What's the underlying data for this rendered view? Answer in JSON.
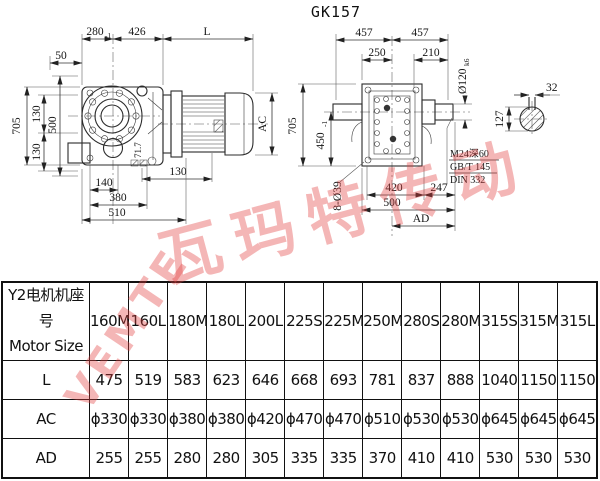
{
  "title": "GK157",
  "watermark": {
    "latin": "VEMTE",
    "cn": "瓦玛特传动"
  },
  "left_view": {
    "dim_280": "280",
    "dim_280_tol": "-1",
    "dim_426": "426",
    "dim_L": "L",
    "dim_50": "50",
    "dim_705": "705",
    "dim_130_top": "130",
    "dim_500": "500",
    "dim_130_mid": "130",
    "dim_130_foot": "130",
    "dim_140": "140",
    "dim_380": "380",
    "dim_510": "510",
    "dim_AC": "AC",
    "dim_angle": "71.7"
  },
  "right_view": {
    "dim_457_left": "457",
    "dim_457_right": "457",
    "dim_250": "250",
    "dim_210": "210",
    "dim_dia120": "Ø120",
    "dim_dia120_tol": "k6",
    "dim_705": "705",
    "dim_450": "450",
    "dim_450_tol": "-1",
    "dim_holes": "8-Ø39",
    "dim_420": "420",
    "dim_247": "247",
    "dim_500": "500",
    "dim_AD": "AD",
    "note_tap": "M24深60",
    "note_gbt": "GB/T 145",
    "note_din": "DIN 332",
    "shaft_key_width": "32",
    "shaft_dia": "127"
  },
  "table": {
    "header_line1": "Y2电机机座号",
    "header_line2": "Motor Size",
    "columns": [
      "160M",
      "160L",
      "180M",
      "180L",
      "200L",
      "225S",
      "225M",
      "250M",
      "280S",
      "280M",
      "315S",
      "315M",
      "315L"
    ],
    "rows": [
      {
        "label": "L",
        "values": [
          "475",
          "519",
          "583",
          "623",
          "646",
          "668",
          "693",
          "781",
          "837",
          "888",
          "1040",
          "1150",
          "1150"
        ]
      },
      {
        "label": "AC",
        "values": [
          "ϕ330",
          "ϕ330",
          "ϕ380",
          "ϕ380",
          "ϕ420",
          "ϕ470",
          "ϕ470",
          "ϕ510",
          "ϕ530",
          "ϕ530",
          "ϕ645",
          "ϕ645",
          "ϕ645"
        ]
      },
      {
        "label": "AD",
        "values": [
          "255",
          "255",
          "280",
          "280",
          "305",
          "335",
          "335",
          "370",
          "410",
          "410",
          "530",
          "530",
          "530"
        ]
      }
    ]
  }
}
